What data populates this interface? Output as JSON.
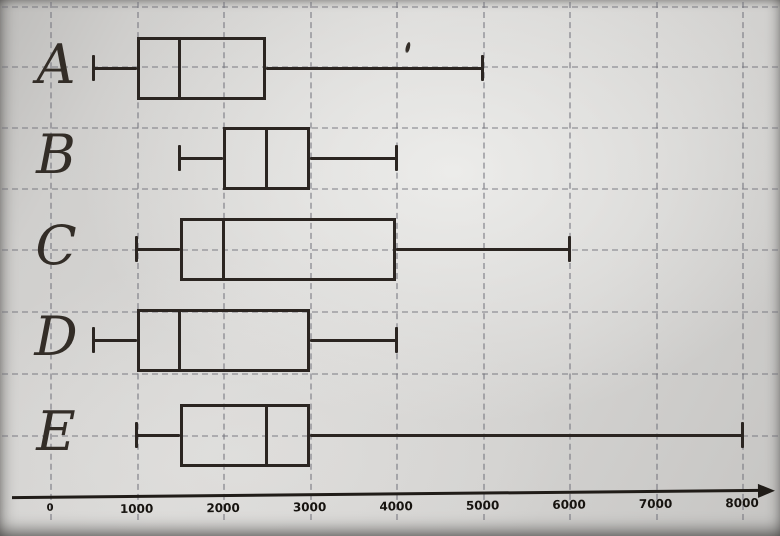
{
  "chart_data": {
    "type": "boxplot",
    "orientation": "horizontal",
    "title": "",
    "xlabel": "",
    "ylabel": "",
    "xlim": [
      0,
      8500
    ],
    "grid": "dashed-both-axes",
    "legend": "none",
    "x_ticks": [
      0,
      1000,
      2000,
      3000,
      4000,
      5000,
      6000,
      7000,
      8000
    ],
    "x_tick_labels": [
      "0",
      "1000",
      "2000",
      "3000",
      "4000",
      "5000",
      "6000",
      "7000",
      "8000"
    ],
    "categories": [
      "A",
      "B",
      "C",
      "D",
      "E"
    ],
    "series": [
      {
        "name": "A",
        "min": 500,
        "q1": 1000,
        "median": 1500,
        "q3": 2500,
        "max": 5000
      },
      {
        "name": "B",
        "min": 1500,
        "q1": 2000,
        "median": 2500,
        "q3": 3000,
        "max": 4000
      },
      {
        "name": "C",
        "min": 1000,
        "q1": 1500,
        "median": 2000,
        "q3": 4000,
        "max": 6000
      },
      {
        "name": "D",
        "min": 500,
        "q1": 1000,
        "median": 1500,
        "q3": 3000,
        "max": 4000
      },
      {
        "name": "E",
        "min": 1000,
        "q1": 1500,
        "median": 2500,
        "q3": 3000,
        "max": 8000
      }
    ]
  },
  "colors": {
    "paper": "#d3d2d0",
    "plot_line": "#2b2521",
    "grid_line": "#70707a",
    "tick_text": "#16130f"
  }
}
